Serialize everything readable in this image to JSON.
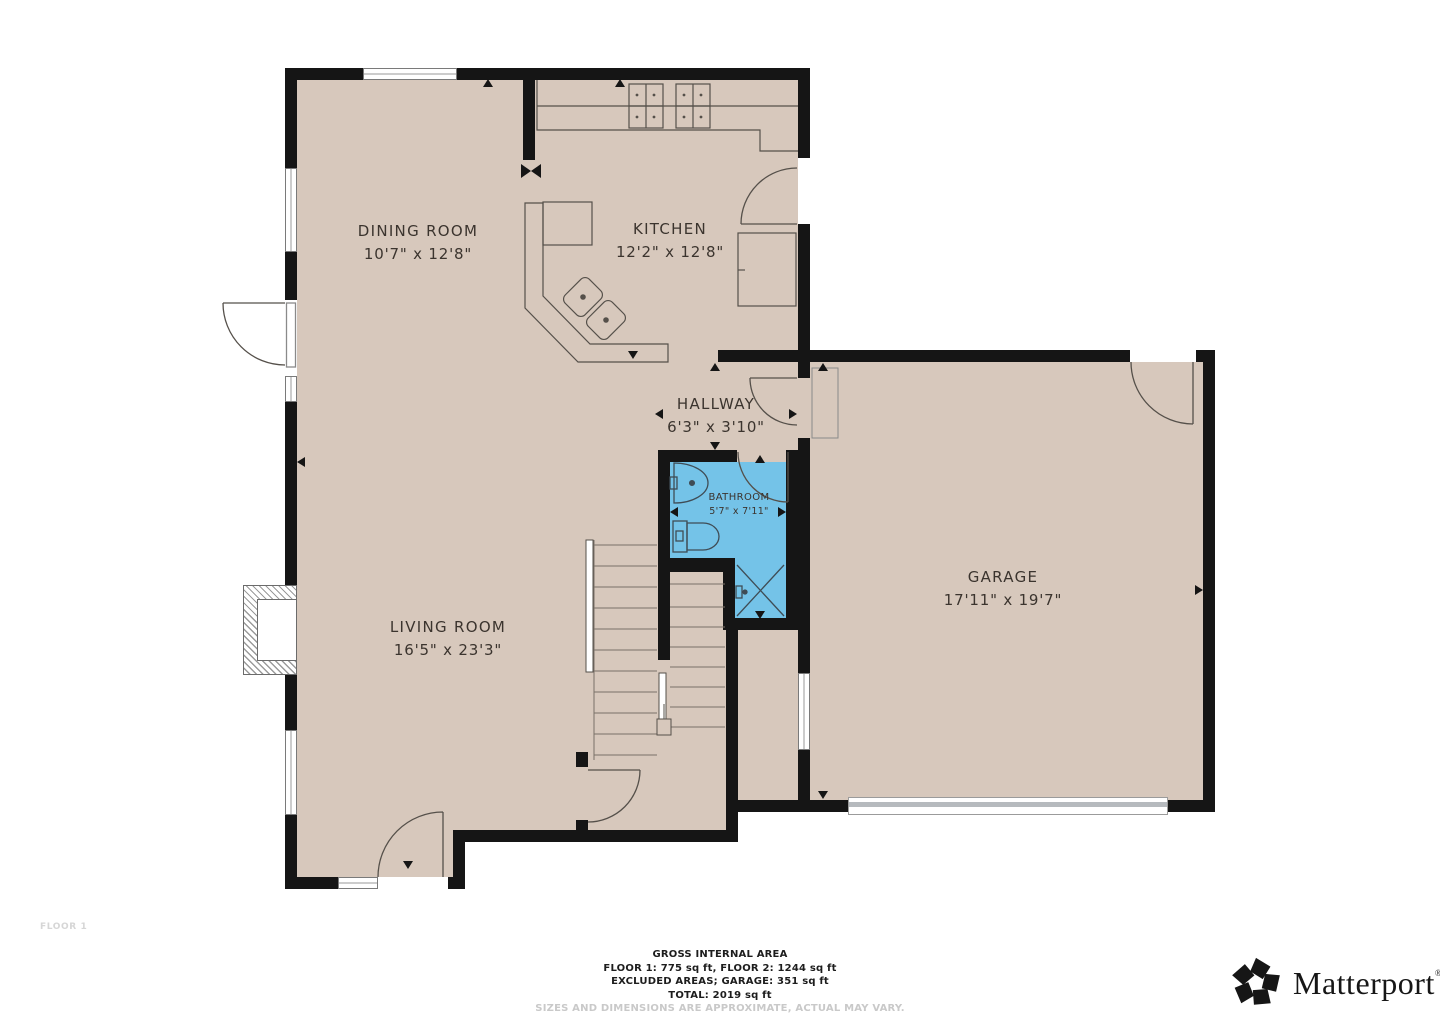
{
  "floor_label": "FLOOR 1",
  "rooms": [
    {
      "id": "dining",
      "name": "DINING ROOM",
      "dims": "10'7\" x 12'8\""
    },
    {
      "id": "kitchen",
      "name": "KITCHEN",
      "dims": "12'2\" x 12'8\""
    },
    {
      "id": "hallway",
      "name": "HALLWAY",
      "dims": "6'3\" x 3'10\""
    },
    {
      "id": "bathroom",
      "name": "BATHROOM",
      "dims": "5'7\" x 7'11\""
    },
    {
      "id": "living",
      "name": "LIVING ROOM",
      "dims": "16'5\" x 23'3\""
    },
    {
      "id": "garage",
      "name": "GARAGE",
      "dims": "17'11\" x 19'7\""
    }
  ],
  "footer": {
    "title": "GROSS INTERNAL AREA",
    "line1": "FLOOR 1: 775 sq ft, FLOOR 2: 1244 sq ft",
    "line2": "EXCLUDED AREAS; GARAGE: 351 sq ft",
    "line3": "TOTAL: 2019 sq ft",
    "disclaimer": "SIZES AND DIMENSIONS ARE APPROXIMATE, ACTUAL MAY VARY."
  },
  "branding": {
    "logo_text": "Matterport",
    "registered_mark": "®"
  },
  "colors": {
    "floor": "#d7c8bc",
    "wall": "#151515",
    "bathroom_highlight": "#74c3e8",
    "label_text": "#3b342e",
    "muted_text": "#c9c9c9",
    "background": "#ffffff"
  }
}
